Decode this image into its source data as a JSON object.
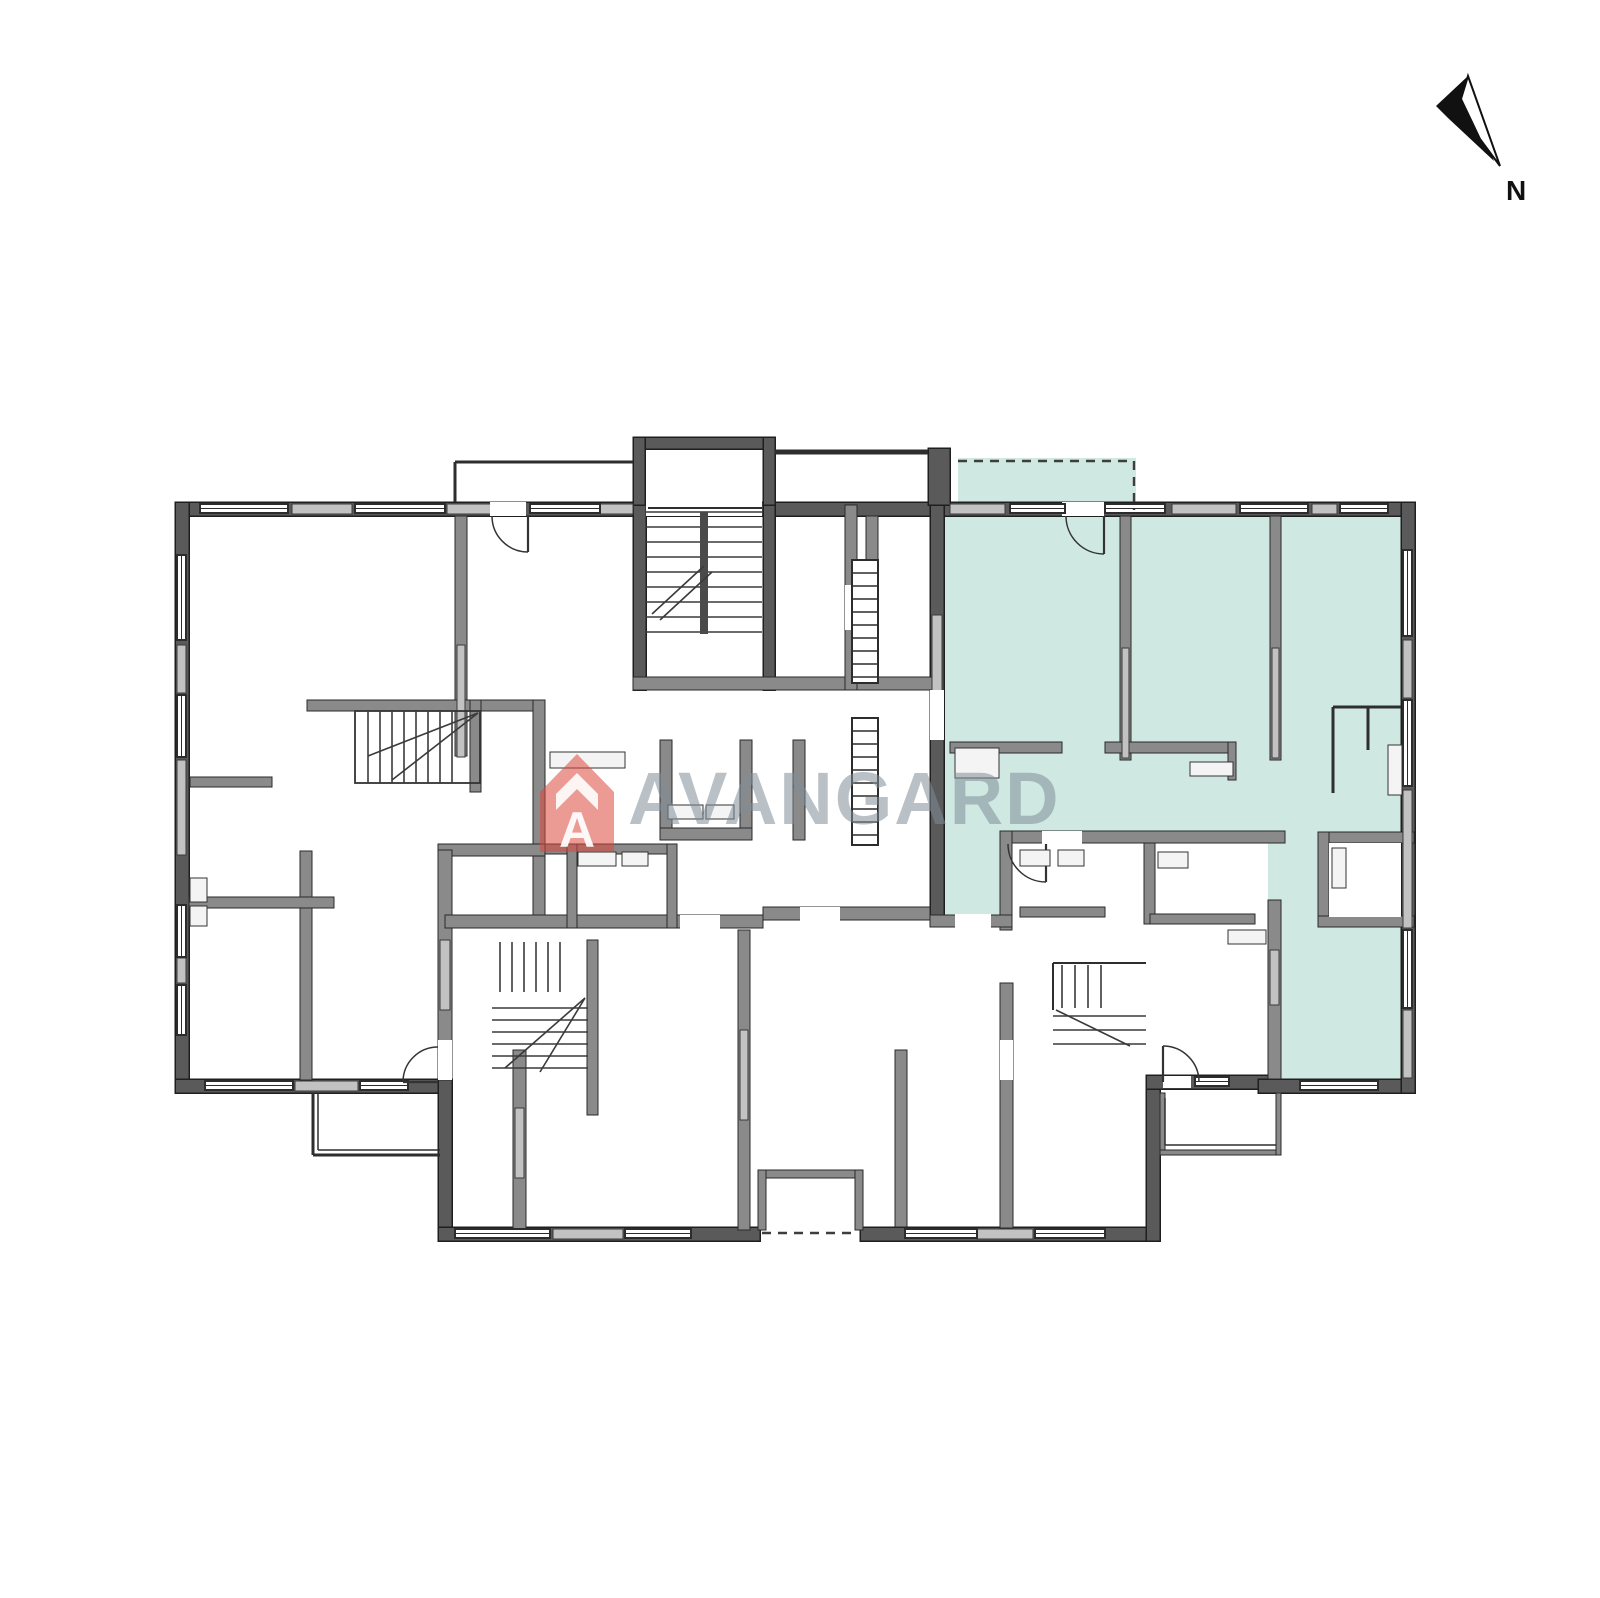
{
  "labels": {
    "north": "N",
    "brand": "AVANGARD",
    "brand_letter": "A"
  },
  "colors": {
    "background": "#ffffff",
    "teal": "#cfe8e2",
    "wallDark": "#5a5a5a",
    "wallMid": "#8a8a8a",
    "wallLight": "#c2c2c2",
    "line": "#2e2e2e",
    "logoRed": "rgba(219,72,58,0.55)",
    "logoGray": "rgba(128,140,152,0.55)",
    "north": "#111111",
    "fixture": "#f4f4f4"
  },
  "north": {
    "solid_points": "1468,76 1436,106 1448,118 1494,161 1477,118",
    "outline_points": "1468,76 1500,166 1480,139 1461,99",
    "label_x": 1506,
    "label_y": 200,
    "label_size": 28
  },
  "logo": {
    "icon_points": "540,792 577,754 614,792 614,852 540,852",
    "chevron_points": "556,810 556,794 577,773 598,794 598,810 577,789",
    "letter_x": 577,
    "letter_y": 847,
    "letter_size": 50,
    "text_x": 628,
    "text_y": 824,
    "text_size": 74
  },
  "plan": {
    "teal": [
      [
        958,
        458,
        178,
        47
      ],
      [
        944,
        515,
        457,
        323
      ],
      [
        944,
        838,
        68,
        80
      ],
      [
        1268,
        838,
        133,
        242
      ]
    ],
    "wallsDark": [
      [
        175,
        502,
        1240,
        14
      ],
      [
        175,
        502,
        14,
        591
      ],
      [
        175,
        1079,
        277,
        14
      ],
      [
        438,
        1079,
        14,
        162
      ],
      [
        438,
        1227,
        322,
        14
      ],
      [
        860,
        1227,
        300,
        14
      ],
      [
        1146,
        1075,
        14,
        166
      ],
      [
        1146,
        1075,
        126,
        14
      ],
      [
        1258,
        1079,
        157,
        14
      ],
      [
        1401,
        502,
        14,
        591
      ],
      [
        633,
        437,
        142,
        12
      ],
      [
        633,
        437,
        12,
        78
      ],
      [
        763,
        437,
        12,
        78
      ],
      [
        928,
        448,
        22,
        57
      ],
      [
        930,
        505,
        14,
        420
      ],
      [
        633,
        505,
        13,
        185
      ],
      [
        763,
        505,
        12,
        185
      ]
    ],
    "wallsMid": [
      [
        455,
        516,
        12,
        240
      ],
      [
        307,
        700,
        238,
        11
      ],
      [
        470,
        700,
        11,
        92
      ],
      [
        300,
        851,
        12,
        229
      ],
      [
        189,
        897,
        145,
        11
      ],
      [
        190,
        777,
        82,
        10
      ],
      [
        533,
        700,
        12,
        216
      ],
      [
        438,
        844,
        107,
        12
      ],
      [
        438,
        850,
        14,
        230
      ],
      [
        633,
        677,
        300,
        13
      ],
      [
        845,
        505,
        12,
        185
      ],
      [
        866,
        516,
        12,
        161
      ],
      [
        793,
        740,
        12,
        100
      ],
      [
        660,
        740,
        12,
        100
      ],
      [
        740,
        740,
        12,
        100
      ],
      [
        660,
        828,
        92,
        12
      ],
      [
        1120,
        516,
        11,
        244
      ],
      [
        1270,
        516,
        11,
        244
      ],
      [
        950,
        742,
        112,
        11
      ],
      [
        1105,
        742,
        128,
        11
      ],
      [
        1228,
        742,
        8,
        38
      ],
      [
        1000,
        831,
        285,
        12
      ],
      [
        1000,
        831,
        12,
        99
      ],
      [
        1144,
        843,
        11,
        81
      ],
      [
        1020,
        907,
        85,
        10
      ],
      [
        1150,
        914,
        105,
        10
      ],
      [
        1318,
        832,
        96,
        11
      ],
      [
        1318,
        832,
        11,
        95
      ],
      [
        1318,
        916,
        96,
        11
      ],
      [
        1268,
        900,
        13,
        179
      ],
      [
        930,
        915,
        82,
        12
      ],
      [
        513,
        1050,
        13,
        180
      ],
      [
        587,
        940,
        11,
        175
      ],
      [
        738,
        930,
        12,
        300
      ],
      [
        895,
        1050,
        12,
        177
      ],
      [
        1000,
        983,
        13,
        245
      ],
      [
        445,
        915,
        318,
        13
      ],
      [
        763,
        907,
        167,
        13
      ],
      [
        545,
        844,
        132,
        10
      ],
      [
        567,
        844,
        10,
        84
      ],
      [
        667,
        844,
        10,
        84
      ],
      [
        1160,
        1093,
        5,
        62
      ],
      [
        1160,
        1150,
        121,
        5
      ],
      [
        1276,
        1093,
        5,
        62
      ],
      [
        758,
        1170,
        105,
        8
      ],
      [
        758,
        1170,
        8,
        60
      ],
      [
        855,
        1170,
        8,
        60
      ]
    ],
    "wallsLight": [
      [
        292,
        504,
        60,
        10
      ],
      [
        447,
        504,
        70,
        10
      ],
      [
        600,
        504,
        33,
        10
      ],
      [
        950,
        504,
        55,
        10
      ],
      [
        1070,
        504,
        30,
        10
      ],
      [
        1172,
        504,
        64,
        10
      ],
      [
        1312,
        504,
        25,
        10
      ],
      [
        177,
        645,
        9,
        48
      ],
      [
        177,
        760,
        9,
        95
      ],
      [
        177,
        958,
        9,
        25
      ],
      [
        1403,
        640,
        9,
        58
      ],
      [
        1403,
        790,
        9,
        138
      ],
      [
        1403,
        1010,
        9,
        68
      ],
      [
        457,
        645,
        8,
        112
      ],
      [
        1122,
        648,
        7,
        110
      ],
      [
        1272,
        648,
        7,
        110
      ],
      [
        515,
        1108,
        9,
        70
      ],
      [
        740,
        1030,
        8,
        90
      ],
      [
        440,
        940,
        10,
        70
      ],
      [
        932,
        615,
        10,
        120
      ],
      [
        553,
        1229,
        70,
        10
      ],
      [
        977,
        1229,
        56,
        10
      ],
      [
        295,
        1081,
        63,
        10
      ],
      [
        1270,
        950,
        9,
        55
      ]
    ],
    "whiteRects": [
      [
        646,
        501,
        116,
        15
      ],
      [
        1062,
        502,
        42,
        14
      ],
      [
        490,
        502,
        36,
        14
      ],
      [
        845,
        585,
        12,
        45
      ],
      [
        930,
        690,
        14,
        50
      ],
      [
        1042,
        831,
        40,
        13
      ],
      [
        680,
        915,
        40,
        14
      ],
      [
        800,
        907,
        40,
        14
      ],
      [
        438,
        1040,
        14,
        40
      ],
      [
        1000,
        1040,
        13,
        40
      ],
      [
        1163,
        1076,
        28,
        12
      ],
      [
        1329,
        843,
        72,
        74
      ],
      [
        955,
        914,
        36,
        14
      ]
    ],
    "windows": [
      [
        200,
        504,
        88,
        9
      ],
      [
        355,
        504,
        90,
        9
      ],
      [
        530,
        504,
        70,
        9
      ],
      [
        1010,
        504,
        55,
        9
      ],
      [
        1105,
        504,
        60,
        9
      ],
      [
        1240,
        504,
        68,
        9
      ],
      [
        1340,
        504,
        48,
        9
      ],
      [
        177,
        555,
        9,
        85
      ],
      [
        177,
        695,
        9,
        62
      ],
      [
        177,
        905,
        9,
        52
      ],
      [
        177,
        985,
        9,
        50
      ],
      [
        205,
        1081,
        88,
        9
      ],
      [
        360,
        1081,
        48,
        9
      ],
      [
        455,
        1229,
        95,
        9
      ],
      [
        625,
        1229,
        66,
        9
      ],
      [
        905,
        1229,
        72,
        9
      ],
      [
        1035,
        1229,
        70,
        9
      ],
      [
        1300,
        1081,
        78,
        9
      ],
      [
        1403,
        550,
        9,
        86
      ],
      [
        1403,
        700,
        9,
        86
      ],
      [
        1403,
        930,
        9,
        78
      ],
      [
        1195,
        1077,
        34,
        9
      ]
    ],
    "thin": [
      [
        455,
        462,
        633,
        462,
        3
      ],
      [
        455,
        462,
        455,
        502,
        3
      ],
      [
        775,
        452,
        928,
        452,
        5
      ],
      [
        1333,
        793,
        1333,
        707,
        3
      ],
      [
        1333,
        707,
        1401,
        707,
        3
      ],
      [
        1368,
        707,
        1368,
        750,
        3
      ],
      [
        648,
        508,
        762,
        508,
        2
      ],
      [
        1053,
        963,
        1146,
        963,
        2
      ],
      [
        1053,
        963,
        1053,
        1010,
        2
      ],
      [
        313,
        1093,
        313,
        1155,
        3
      ],
      [
        313,
        1155,
        440,
        1155,
        3
      ],
      [
        318,
        1093,
        318,
        1150,
        1.5
      ],
      [
        318,
        1150,
        440,
        1150,
        1.5
      ],
      [
        1165,
        1098,
        1165,
        1145,
        1.5
      ],
      [
        1165,
        1145,
        1276,
        1145,
        1.5
      ]
    ],
    "dashed": [
      [
        958,
        461,
        1134,
        461
      ],
      [
        1134,
        461,
        1134,
        510
      ],
      [
        762,
        1233,
        858,
        1233
      ]
    ],
    "stairs": [
      {
        "stringer": [
          700,
          512,
          8,
          122
        ],
        "treads": {
          "dir": "h",
          "from": 512,
          "to": 632,
          "step": 15,
          "a": 646,
          "b": 762
        },
        "diag": [
          [
            652,
            614,
            704,
            566
          ],
          [
            660,
            620,
            712,
            572
          ]
        ]
      },
      {
        "box": [
          355,
          711,
          125,
          72
        ],
        "treads": {
          "dir": "v",
          "from": 368,
          "to": 452,
          "step": 12,
          "a": 711,
          "b": 783
        },
        "diag": [
          [
            478,
            713,
            392,
            780
          ],
          [
            478,
            713,
            368,
            756
          ]
        ]
      },
      {
        "treads": {
          "dir": "v",
          "from": 500,
          "to": 560,
          "step": 12,
          "a": 942,
          "b": 992
        },
        "treads2": {
          "dir": "h",
          "from": 1008,
          "to": 1068,
          "step": 12,
          "a": 492,
          "b": 588
        },
        "diag": [
          [
            585,
            998,
            505,
            1068
          ],
          [
            585,
            998,
            540,
            1072
          ]
        ]
      },
      {
        "treads": {
          "dir": "v",
          "from": 1062,
          "to": 1102,
          "step": 13,
          "a": 965,
          "b": 1008
        },
        "treads2": {
          "dir": "h",
          "from": 1016,
          "to": 1044,
          "step": 14,
          "a": 1053,
          "b": 1146
        },
        "diag": [
          [
            1056,
            1010,
            1130,
            1046
          ]
        ]
      }
    ],
    "shafts": [
      [
        852,
        560,
        26,
        123,
        13
      ],
      [
        852,
        718,
        26,
        127,
        13
      ]
    ],
    "doors": [
      {
        "arc": "M1104,554 A38,38 0 0 1 1066,516",
        "leaf": [
          1104,
          516,
          1104,
          554
        ]
      },
      {
        "arc": "M1046,882 A38,38 0 0 1 1008,844",
        "leaf": [
          1046,
          844,
          1046,
          882
        ]
      },
      {
        "arc": "M528,552 A36,36 0 0 1 492,516",
        "leaf": [
          528,
          516,
          528,
          552
        ]
      },
      {
        "arc": "M403,1082 A35,35 0 0 1 438,1047",
        "leaf": [
          403,
          1082,
          438,
          1082
        ]
      },
      {
        "arc": "M1163,1046 A36,36 0 0 1 1199,1082",
        "leaf": [
          1163,
          1082,
          1163,
          1046
        ]
      }
    ],
    "fixtures": [
      [
        550,
        752,
        75,
        16
      ],
      [
        668,
        805,
        35,
        14
      ],
      [
        706,
        805,
        28,
        14
      ],
      [
        190,
        878,
        17,
        24
      ],
      [
        190,
        906,
        17,
        20
      ],
      [
        955,
        748,
        44,
        30
      ],
      [
        1190,
        762,
        43,
        14
      ],
      [
        1388,
        745,
        14,
        50
      ],
      [
        1020,
        850,
        30,
        16
      ],
      [
        1058,
        850,
        26,
        16
      ],
      [
        1158,
        852,
        30,
        16
      ],
      [
        578,
        852,
        38,
        14
      ],
      [
        622,
        852,
        26,
        14
      ],
      [
        1228,
        930,
        38,
        14
      ],
      [
        1332,
        848,
        14,
        40
      ]
    ]
  }
}
